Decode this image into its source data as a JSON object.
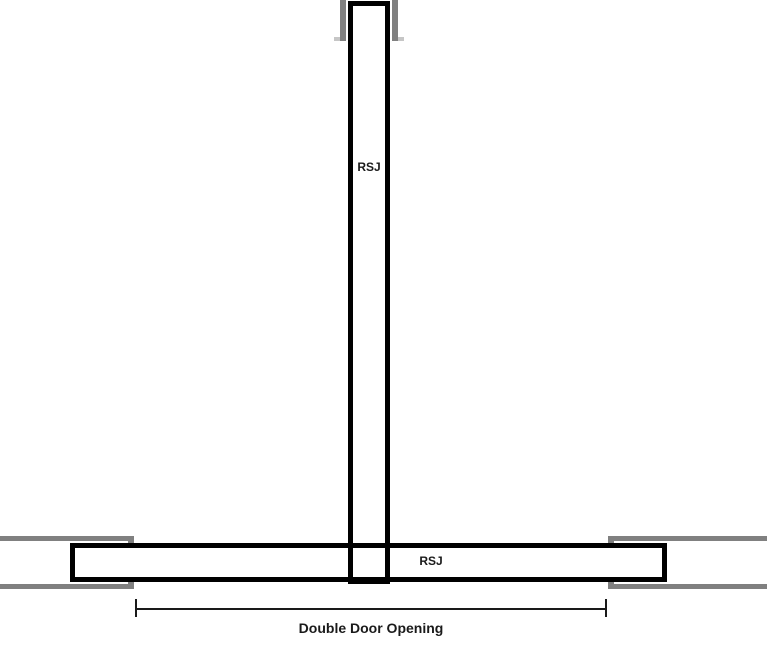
{
  "labels": {
    "vertical_beam": "RSJ",
    "horizontal_beam": "RSJ",
    "dimension": "Double Door Opening"
  },
  "colors": {
    "beam-outline": "#000000",
    "wall-gray": "#808080",
    "background": "#ffffff",
    "dimension-line": "#1a1a1a"
  }
}
